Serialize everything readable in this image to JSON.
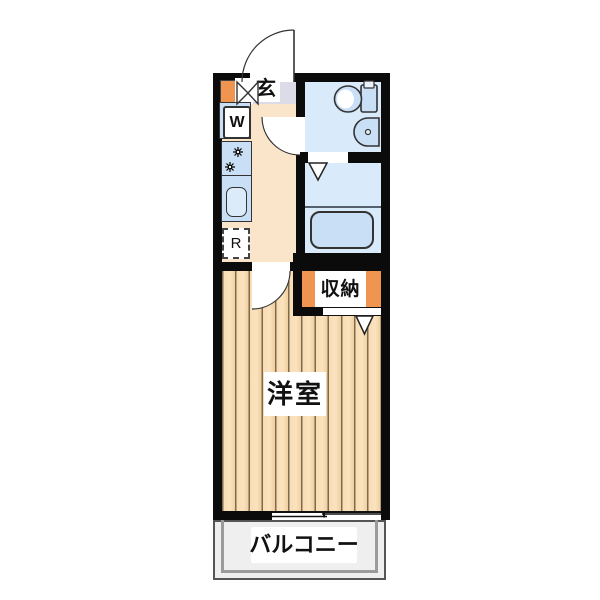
{
  "plan": {
    "type": "japanese-apartment-floor-plan",
    "labels": {
      "entrance": "玄",
      "washer": "W",
      "refrigerator": "R",
      "storage": "収納",
      "main_room": "洋室",
      "balcony": "バルコニー"
    },
    "colors": {
      "wall": "#0b0b0b",
      "hall_floor": "#fae5cb",
      "entry_floor": "#dcdbe8",
      "wet_room_floor": "#d9eafa",
      "fixture_fill": "#c8dff5",
      "accent_orange": "#f0954f",
      "room_floor_plank": "#f8dcb4",
      "balcony_floor": "#efefef"
    },
    "fixtures": [
      "entrance-door",
      "bifold-door",
      "washing-machine",
      "gas-stove",
      "kitchen-sink",
      "refrigerator",
      "toilet",
      "hand-sink",
      "bathtub",
      "folding-doors",
      "sliding-window"
    ]
  }
}
